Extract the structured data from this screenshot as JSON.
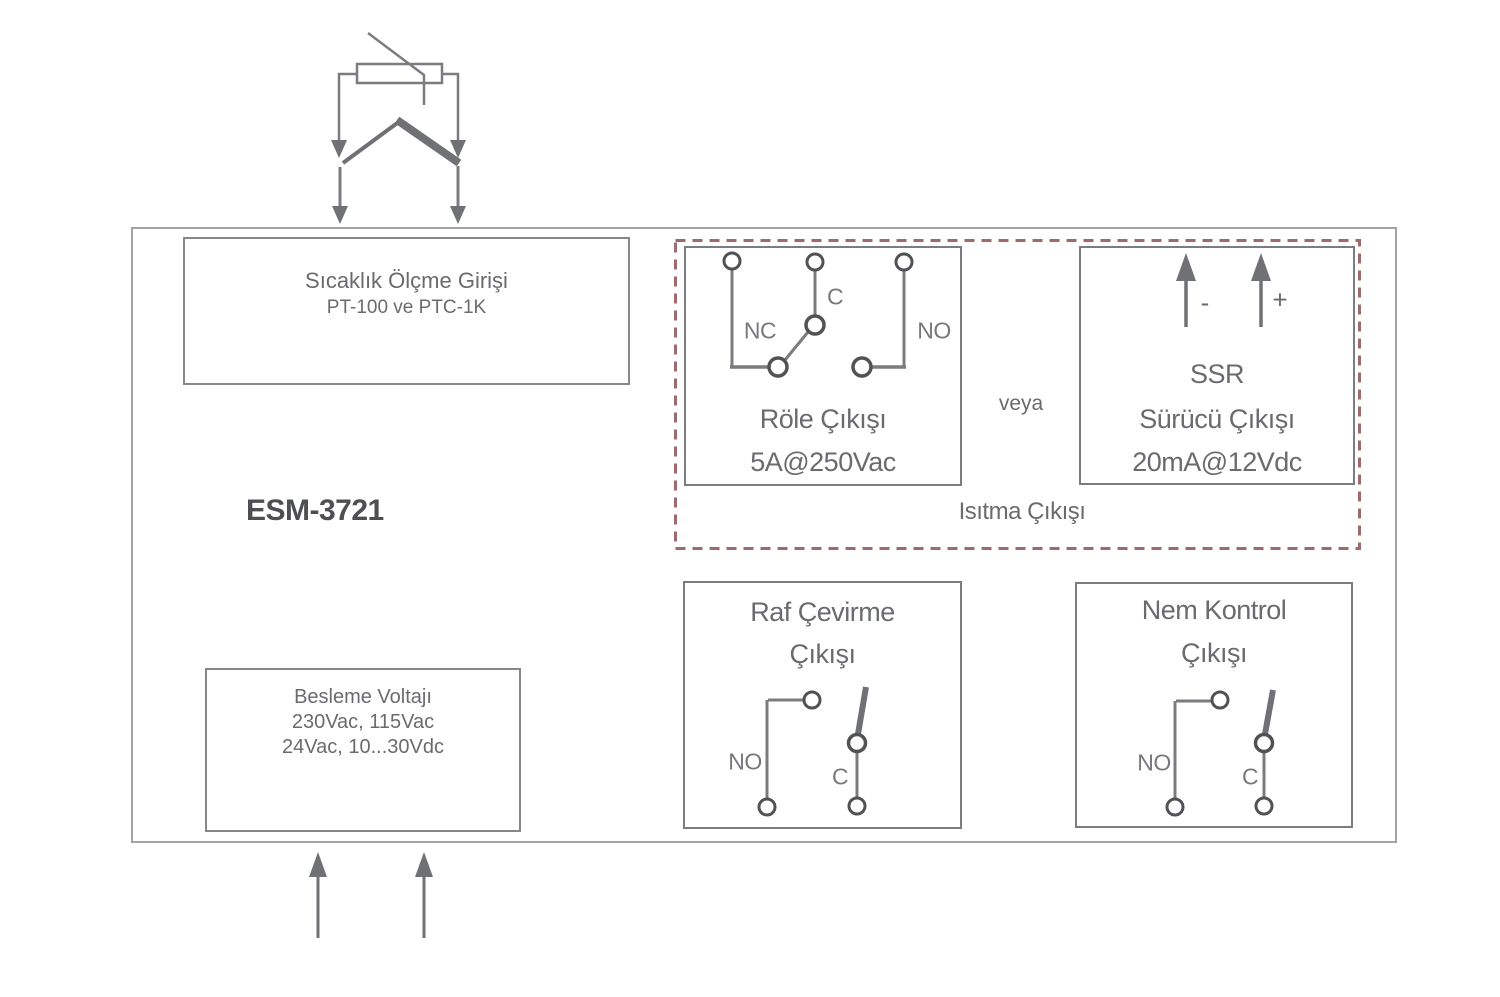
{
  "device": {
    "model_label": "ESM-3721"
  },
  "temperature_input": {
    "title": "Sıcaklık Ölçme Girişi",
    "subtitle": "PT-100 ve PTC-1K"
  },
  "power_input": {
    "lines": [
      "Besleme Voltajı",
      "230Vac, 115Vac",
      "24Vac, 10...30Vdc"
    ]
  },
  "heating_output": {
    "caption": "Isıtma Çıkışı",
    "or_label": "veya",
    "relay_output": {
      "title": "Röle Çıkışı",
      "rating": "5A@250Vac",
      "terminal_nc": "NC",
      "terminal_c": "C",
      "terminal_no": "NO"
    },
    "ssr_output": {
      "line1": "SSR",
      "line2": "Sürücü Çıkışı",
      "line3": "20mA@12Vdc",
      "polarity_minus": "-",
      "polarity_plus": "+"
    }
  },
  "shelf_turning_output": {
    "title_line1": "Raf Çevirme",
    "title_line2": "Çıkışı",
    "terminal_no": "NO",
    "terminal_c": "C"
  },
  "humidity_control_output": {
    "title_line1": "Nem Kontrol",
    "title_line2": "Çıkışı",
    "terminal_no": "NO",
    "terminal_c": "C"
  },
  "colors": {
    "line_gray": "#7a7c7f",
    "circle_gray": "#515254",
    "arrow_gray": "#707174",
    "text_gray": "#6a6b6e",
    "dark_text": "#4d4f52",
    "dashed_red": "#a0696e"
  }
}
